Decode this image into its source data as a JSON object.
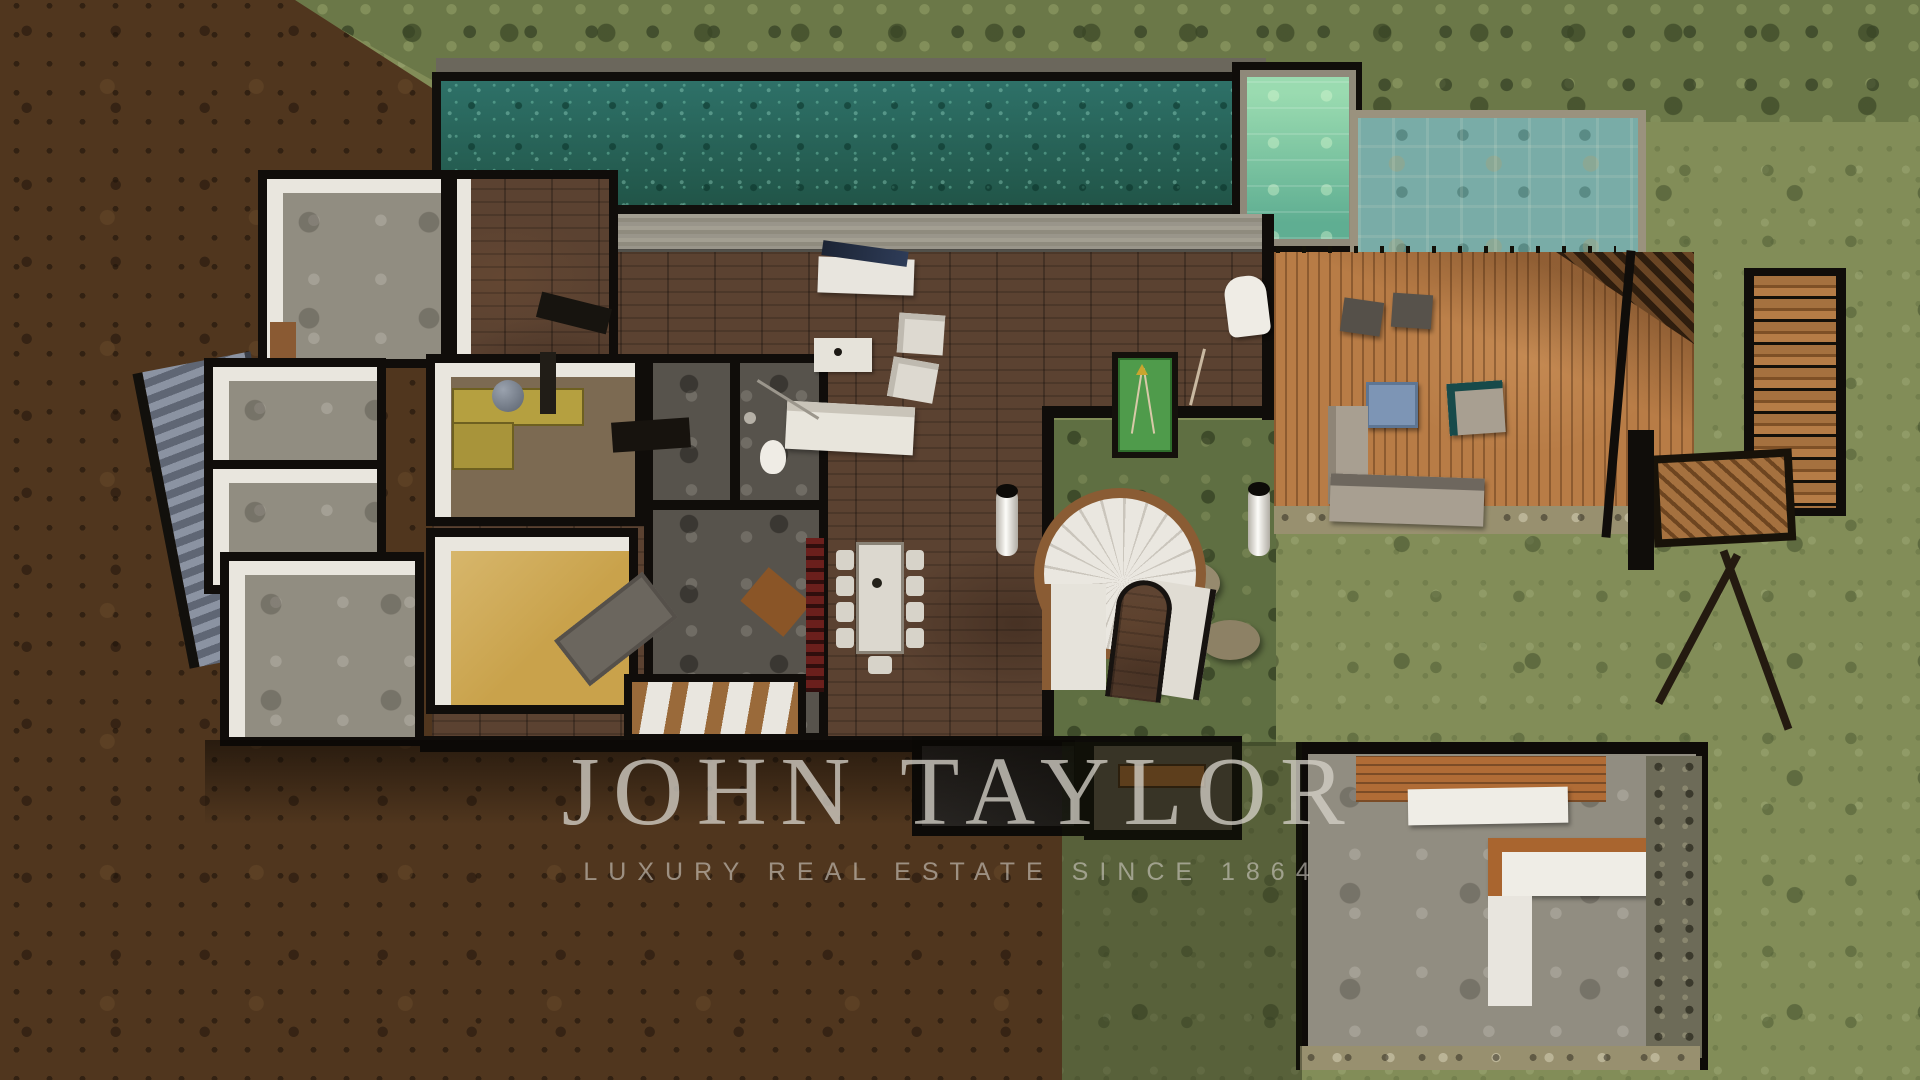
{
  "watermark": {
    "brand": "JOHN TAYLOR",
    "tagline": "LUXURY REAL ESTATE SINCE 1864"
  },
  "palette": {
    "pool_water": "#2e7168",
    "secondary_pool_tiles": "#79aca7",
    "jacuzzi_water": "#8fd0a8",
    "deck_wood": "#b87c46",
    "interior_parquet": "#5b4231",
    "walls": "#100d0a",
    "white_interior_walls": "#e9e6de",
    "concrete_floor": "#918d81",
    "dirt_ground": "#50361e",
    "vegetation": "#828d58",
    "billiard_felt": "#4f9b4b",
    "red_bookshelf": "#6b1f1c",
    "watermark_text": "#d4cfc7"
  }
}
